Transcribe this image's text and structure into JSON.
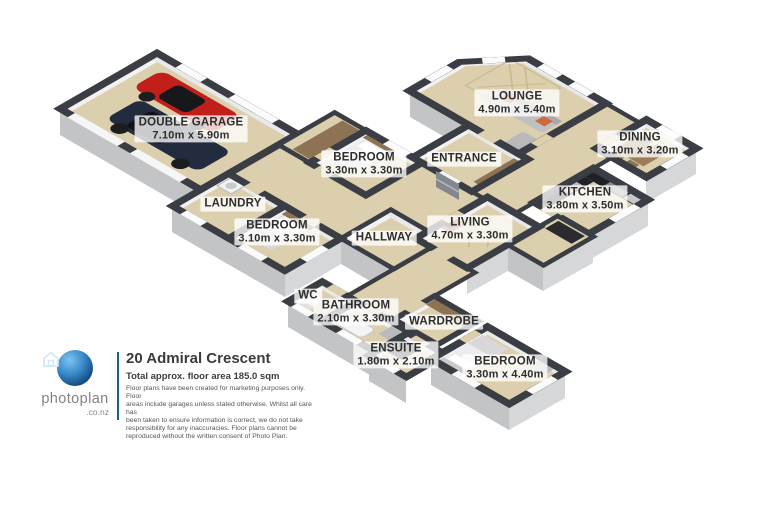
{
  "canvas": {
    "width": 768,
    "height": 512,
    "background": "#ffffff"
  },
  "floorplan": {
    "colors": {
      "floor": "#dccfae",
      "wall_top": "#3a3d43",
      "exterior_face_left": "#c3c4c6",
      "exterior_face_right": "#d6d7d9",
      "inner_wall_light": "#f2f2f4",
      "label_bg": "rgba(255,255,255,0.78)",
      "label_text": "#2d2d2d",
      "car_red": "#c01f1a",
      "car_navy": "#232b3e"
    },
    "rooms": [
      {
        "id": "double-garage",
        "label": "DOUBLE GARAGE",
        "dims": "7.10m x 5.90m",
        "x": 191,
        "y": 129
      },
      {
        "id": "bedroom-1",
        "label": "BEDROOM",
        "dims": "3.30m x 3.30m",
        "x": 364,
        "y": 164
      },
      {
        "id": "entrance",
        "label": "ENTRANCE",
        "dims": "",
        "x": 464,
        "y": 159
      },
      {
        "id": "lounge",
        "label": "LOUNGE",
        "dims": "4.90m x 5.40m",
        "x": 517,
        "y": 103
      },
      {
        "id": "dining",
        "label": "DINING",
        "dims": "3.10m x 3.20m",
        "x": 640,
        "y": 144
      },
      {
        "id": "kitchen",
        "label": "KITCHEN",
        "dims": "3.80m x 3.50m",
        "x": 585,
        "y": 199
      },
      {
        "id": "laundry",
        "label": "LAUNDRY",
        "dims": "",
        "x": 233,
        "y": 204
      },
      {
        "id": "bedroom-2",
        "label": "BEDROOM",
        "dims": "3.10m x 3.30m",
        "x": 277,
        "y": 232
      },
      {
        "id": "hallway",
        "label": "HALLWAY",
        "dims": "",
        "x": 384,
        "y": 238
      },
      {
        "id": "living",
        "label": "LIVING",
        "dims": "4.70m x 3.30m",
        "x": 470,
        "y": 229
      },
      {
        "id": "wc",
        "label": "WC",
        "dims": "",
        "x": 308,
        "y": 296
      },
      {
        "id": "bathroom",
        "label": "BATHROOM",
        "dims": "2.10m x 3.30m",
        "x": 356,
        "y": 312
      },
      {
        "id": "wardrobe",
        "label": "WARDROBE",
        "dims": "",
        "x": 444,
        "y": 322
      },
      {
        "id": "ensuite",
        "label": "ENSUITE",
        "dims": "1.80m x 2.10m",
        "x": 396,
        "y": 355
      },
      {
        "id": "bedroom-3",
        "label": "BEDROOM",
        "dims": "3.30m x 4.40m",
        "x": 505,
        "y": 368
      }
    ]
  },
  "footer": {
    "brand": "photoplan",
    "brand_suffix": ".co.nz",
    "address": "20 Admiral Crescent",
    "area": "Total approx. floor area 185.0 sqm",
    "disclaimer_lines": [
      "Floor plans have been created for marketing purposes only. Floor",
      "areas include garages unless stated otherwise. Whilst all care has",
      "been taken to ensure information is correct, we do not take",
      "responsibility for any inaccuracies. Floor plans cannot be",
      "reproduced without the written consent of Photo Plan."
    ]
  }
}
